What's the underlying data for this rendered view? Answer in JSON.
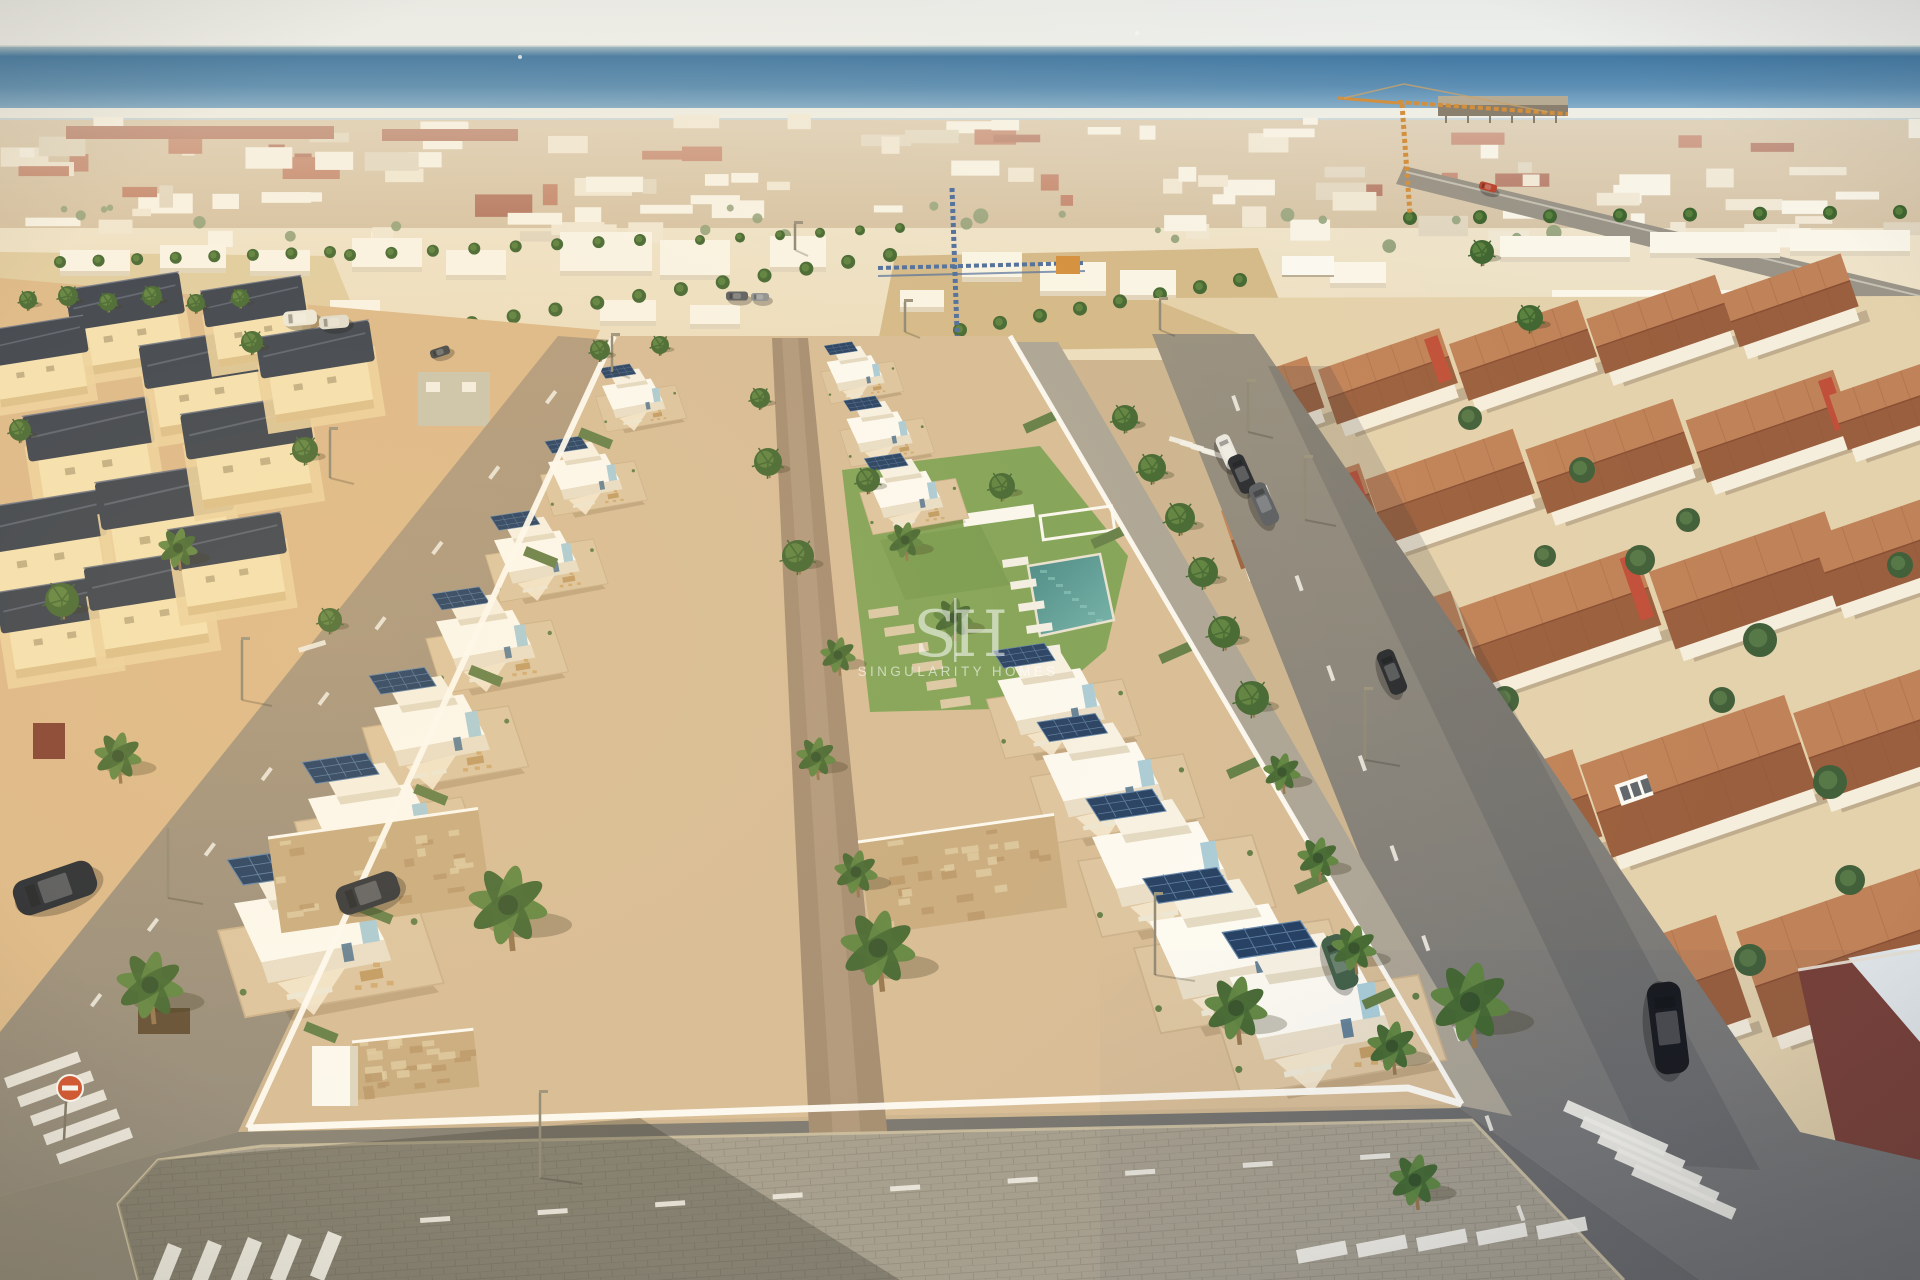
{
  "meta": {
    "description": "Aerial drone render of a new-build residential development of white modern villas with solar panels, communal lawn and pool, between older cream villas with dark roofs (left) and terracotta-roofed townhouses (right), sea and dense coastal town on the horizon, two construction cranes, palm-lined streets, zebra crossings on the corner roads.",
    "width": 1920,
    "height": 1280
  },
  "watermark": {
    "initial_left": "S",
    "separator": "|",
    "initial_right": "H",
    "brand": "SINGULARITY HOMES"
  },
  "palette": {
    "sky_top": "#e9ebe9",
    "sky_bottom": "#eef0ed",
    "sea_horizon": "#a3bcc7",
    "sea_deep": "#447aa4",
    "sea_mid": "#5d8fb4",
    "sea_light": "#a9c4d4",
    "surf": "#eef2ee",
    "distant_white": "#faf6ea",
    "distant_cream": "#efe5cf",
    "distant_shadow": "#d9cdb4",
    "roof_terracotta": "#ae5a3e",
    "roof_darkred": "#98462f",
    "sand": "#e0cda4",
    "sand_deep": "#d3b98a",
    "palm_dark": "#3f6531",
    "palm_light": "#5c8440",
    "trunk": "#93744e",
    "dev_ground": "#d6bc98",
    "dev_white": "#fdfcf7",
    "dev_shade": "#e8dfcc",
    "terrace": "#dcc5a2",
    "wood": "#bf9a63",
    "solar": "#1c3a62",
    "solar_grid": "#5d83ad",
    "accent_blue": "#a7ccdb",
    "accent_steel": "#4f7391",
    "lawn": "#7da257",
    "pool": "#3f8586",
    "pool_light": "#6fb3ae",
    "old_wall": "#f5e3b4",
    "old_roof": "#333d4d",
    "old_ground": "#dcb98b",
    "rq_wall": "#f6eedd",
    "rq_ground": "#e4d2ad",
    "red_gable": "#c1503a",
    "roof_hi": "#c08258",
    "roof_lo": "#9a5f3e",
    "asphalt_warm": "#a5927b",
    "asphalt": "#958e7e",
    "asphalt_cool": "#6f7174",
    "sidewalk": "#a39d8f",
    "sidewalk_line": "#938d7f",
    "curb": "#cabfa2",
    "white_wall": "#fefdf9",
    "stone": "#c7ab81",
    "crane_orange": "#d28f3e",
    "crane_blue": "#4a6c9e",
    "marking": "#f2f1ea",
    "brick_red": "#7a4038",
    "sign_red": "#d2512e"
  },
  "scene": {
    "polys": {
      "left_quarter": "0,278 600,330 236,1128 0,1040",
      "right_quarter": "1150,298 1920,296 1920,1280 1790,1280 1250,338",
      "plaza": "895,256 1258,248 1298,346 876,352",
      "left_lot": "0,252 332,256 362,330 0,342",
      "coast_road": "1404,166 1920,290 1920,314 1396,184",
      "left_street": "0,1032 558,336 612,340 238,1132 0,1196",
      "right_street": "1152,334 1254,334 1800,1132 1920,1160 1920,1280 1700,1280 1460,1108",
      "bottom_road": "0,1196 238,1132 1460,1108 1700,1280 0,1280",
      "right_walk": "1012,342 1058,342 1512,1116 1462,1106",
      "dev_plot": "614,336 1010,336 1462,1104 248,1128",
      "walkway": "772,338 808,338 902,1280 816,1280",
      "lawn": "842,470 1040,446 1128,556 1106,650 1038,708 870,712",
      "pool": "1028,566 1100,554 1114,620 1040,636",
      "sidewalk": "138,1280 118,1204 158,1160 262,1146 1472,1120 1624,1280",
      "walk_shadow": "118,1204 158,1160 640,1118 900,1280 138,1280",
      "brick_wall": "1798,970 1920,950 1920,1162 1838,1152",
      "brick_deck": "1848,958 1920,944 1920,1042",
      "street_shadow": "1268,366 1330,366 1760,1170 1650,1164"
    },
    "red_bands": [
      [
        66,
        126,
        268,
        13
      ],
      [
        382,
        129,
        136,
        12
      ]
    ],
    "mid_buildings": [
      [
        352,
        238,
        70,
        34,
        0
      ],
      [
        446,
        250,
        60,
        30,
        0
      ],
      [
        560,
        232,
        92,
        44,
        0
      ],
      [
        660,
        240,
        70,
        40,
        0
      ],
      [
        770,
        236,
        56,
        36,
        0
      ],
      [
        962,
        252,
        60,
        30,
        0
      ],
      [
        1040,
        262,
        66,
        34,
        0
      ],
      [
        1120,
        270,
        56,
        30,
        0
      ],
      [
        330,
        300,
        50,
        24,
        0
      ],
      [
        600,
        300,
        56,
        26,
        0
      ],
      [
        690,
        305,
        50,
        24,
        0
      ],
      [
        900,
        290,
        44,
        22,
        0
      ],
      [
        1330,
        262,
        56,
        26,
        0
      ],
      [
        60,
        250,
        70,
        26,
        0
      ],
      [
        160,
        245,
        66,
        28,
        0
      ],
      [
        250,
        250,
        60,
        26,
        0
      ],
      [
        0,
        300,
        44,
        22,
        0
      ],
      [
        1500,
        236,
        130,
        26,
        0
      ],
      [
        1650,
        232,
        130,
        26,
        0
      ],
      [
        1790,
        230,
        120,
        26,
        0
      ],
      [
        1552,
        290,
        280,
        52,
        1
      ]
    ],
    "pier": [
      1438,
      96,
      130,
      20
    ],
    "ships": [
      [
        1137,
        33
      ],
      [
        520,
        57
      ]
    ],
    "cranes": {
      "blue": {
        "tower": [
          952,
          188,
          958,
          360
        ],
        "jib": [
          878,
          268,
          1085,
          263
        ],
        "cab": [
          1056,
          256,
          24,
          18
        ]
      },
      "orange": {
        "tower": [
          1402,
          104,
          1410,
          214
        ],
        "jib": [
          1398,
          102,
          1568,
          114
        ],
        "counter": [
          1338,
          98,
          1398,
          103
        ],
        "apex": [
          1404,
          84
        ]
      }
    },
    "old_villas": [
      [
        128,
        320,
        0.9
      ],
      [
        38,
        358,
        0.8
      ],
      [
        92,
        450,
        1.0
      ],
      [
        44,
        543,
        1.0
      ],
      [
        205,
        378,
        0.95
      ],
      [
        256,
        318,
        0.8
      ],
      [
        168,
        518,
        1.05
      ],
      [
        250,
        448,
        1.0
      ],
      [
        318,
        368,
        0.9
      ],
      [
        58,
        623,
        0.9
      ],
      [
        150,
        600,
        0.95
      ],
      [
        230,
        560,
        0.9
      ]
    ],
    "left_extras": {
      "green_house": [
        418,
        372,
        72,
        54
      ],
      "container": [
        33,
        723,
        32,
        36
      ],
      "cabinet": [
        312,
        1046,
        46,
        60
      ],
      "corner_planter": [
        138,
        1008,
        52,
        26
      ]
    },
    "right_roofs": [
      [
        1258,
        408,
        118,
        54,
        -19,
        0
      ],
      [
        1390,
        382,
        120,
        58,
        -19,
        1
      ],
      [
        1525,
        356,
        128,
        60,
        -19,
        0
      ],
      [
        1662,
        330,
        128,
        58,
        -19,
        0
      ],
      [
        1792,
        306,
        118,
        56,
        -19,
        0
      ],
      [
        1302,
        522,
        138,
        62,
        -19,
        1
      ],
      [
        1452,
        492,
        148,
        68,
        -19,
        0
      ],
      [
        1612,
        462,
        148,
        68,
        -19,
        0
      ],
      [
        1772,
        432,
        148,
        66,
        -19,
        1
      ],
      [
        1900,
        408,
        118,
        58,
        -19,
        0
      ],
      [
        1382,
        662,
        168,
        78,
        -19,
        0
      ],
      [
        1562,
        622,
        178,
        82,
        -19,
        1
      ],
      [
        1752,
        586,
        178,
        82,
        -19,
        0
      ],
      [
        1900,
        552,
        148,
        74,
        -19,
        0
      ],
      [
        1492,
        832,
        198,
        92,
        -19,
        0
      ],
      [
        1700,
        782,
        208,
        98,
        -19,
        0
      ],
      [
        1898,
        732,
        178,
        92,
        -19,
        1
      ],
      [
        1624,
        1010,
        228,
        108,
        -19,
        0
      ],
      [
        1868,
        952,
        228,
        112,
        -19,
        0
      ]
    ],
    "conservatories": [
      [
        1312,
        592
      ],
      [
        1634,
        790
      ],
      [
        1520,
        960
      ]
    ],
    "rq_pool": [
      1200,
      862,
      34,
      18,
      -19
    ],
    "rq_trees": [
      [
        1640,
        560,
        15
      ],
      [
        1582,
        470,
        13
      ],
      [
        1760,
        640,
        17
      ],
      [
        1505,
        700,
        14
      ],
      [
        1830,
        782,
        17
      ],
      [
        1900,
        565,
        13
      ],
      [
        1470,
        418,
        12
      ],
      [
        1688,
        520,
        12
      ],
      [
        1545,
        556,
        11
      ],
      [
        1722,
        700,
        13
      ],
      [
        1850,
        880,
        15
      ],
      [
        1600,
        900,
        14
      ],
      [
        1750,
        960,
        16
      ]
    ],
    "dev_villas_left": [
      [
        648,
        408,
        0.46
      ],
      [
        602,
        488,
        0.54
      ],
      [
        556,
        570,
        0.62
      ],
      [
        508,
        656,
        0.72
      ],
      [
        458,
        748,
        0.84
      ],
      [
        404,
        845,
        0.96
      ],
      [
        348,
        958,
        1.14
      ]
    ],
    "dev_villas_right": [
      [
        856,
        382,
        0.42
      ],
      [
        880,
        442,
        0.48
      ],
      [
        906,
        506,
        0.55
      ],
      [
        1052,
        718,
        0.78
      ],
      [
        1104,
        798,
        0.88
      ],
      [
        1162,
        885,
        1.0
      ],
      [
        1228,
        975,
        1.12
      ],
      [
        1312,
        1034,
        1.18
      ]
    ],
    "stone_walls": [
      [
        268,
        838,
        212,
        96,
        -8
      ],
      [
        858,
        842,
        198,
        94,
        -8
      ],
      [
        352,
        1042,
        122,
        58,
        -6
      ]
    ],
    "garden": {
      "bench": [
        962,
        514,
        72,
        13,
        -8
      ],
      "pergola": [
        1040,
        516,
        72,
        24,
        -8
      ],
      "loungers_white": [
        [
          1002,
          560
        ],
        [
          1010,
          582
        ],
        [
          1018,
          604
        ],
        [
          1026,
          626
        ],
        [
          1034,
          648
        ]
      ],
      "loungers_tan": [
        [
          868,
          610
        ],
        [
          884,
          628
        ],
        [
          898,
          646
        ],
        [
          912,
          664
        ],
        [
          926,
          682
        ],
        [
          940,
          700
        ]
      ]
    },
    "palms": [
      [
        178,
        548,
        20
      ],
      [
        118,
        756,
        24
      ],
      [
        62,
        600,
        17
      ],
      [
        305,
        450,
        13
      ],
      [
        252,
        342,
        11
      ],
      [
        508,
        905,
        40
      ],
      [
        878,
        948,
        38
      ],
      [
        1236,
        1008,
        32
      ],
      [
        1470,
        1002,
        40
      ],
      [
        1415,
        1180,
        26
      ],
      [
        150,
        985,
        34
      ],
      [
        768,
        462,
        14
      ],
      [
        798,
        556,
        16
      ],
      [
        838,
        655,
        18
      ],
      [
        816,
        757,
        20
      ],
      [
        856,
        872,
        22
      ],
      [
        760,
        398,
        10
      ],
      [
        905,
        540,
        18
      ],
      [
        953,
        618,
        20
      ],
      [
        1002,
        486,
        13
      ],
      [
        868,
        480,
        12
      ],
      [
        1125,
        418,
        13
      ],
      [
        1152,
        468,
        14
      ],
      [
        1180,
        518,
        15
      ],
      [
        1203,
        572,
        15
      ],
      [
        1224,
        632,
        16
      ],
      [
        1252,
        698,
        17
      ],
      [
        1282,
        772,
        19
      ],
      [
        1318,
        858,
        21
      ],
      [
        1354,
        948,
        23
      ],
      [
        1392,
        1046,
        25
      ],
      [
        1530,
        318,
        13
      ],
      [
        1482,
        252,
        12
      ],
      [
        28,
        300,
        9
      ],
      [
        68,
        296,
        10
      ],
      [
        108,
        302,
        9
      ],
      [
        152,
        296,
        10
      ],
      [
        196,
        303,
        9
      ],
      [
        240,
        298,
        9
      ],
      [
        20,
        430,
        11
      ],
      [
        330,
        620,
        12
      ],
      [
        600,
        350,
        10
      ],
      [
        660,
        345,
        9
      ]
    ],
    "palm_rows": [
      [
        430,
        330,
        890,
        255,
        12,
        7
      ],
      [
        960,
        330,
        1240,
        280,
        8,
        7
      ],
      [
        350,
        255,
        640,
        240,
        8,
        6
      ],
      [
        60,
        262,
        330,
        252,
        8,
        6
      ],
      [
        1410,
        218,
        1900,
        212,
        8,
        7
      ],
      [
        700,
        240,
        900,
        228,
        6,
        5
      ]
    ],
    "cars": [
      [
        55,
        888,
        84,
        36,
        -19,
        "#1d2430"
      ],
      [
        368,
        893,
        64,
        30,
        -19,
        "#2b3038"
      ],
      [
        300,
        318,
        34,
        15,
        -5,
        "#eceadf"
      ],
      [
        334,
        322,
        30,
        13,
        -5,
        "#dfddd2"
      ],
      [
        1228,
        452,
        36,
        15,
        66,
        "#e9e8e2"
      ],
      [
        1242,
        474,
        40,
        17,
        66,
        "#23272f"
      ],
      [
        1264,
        504,
        44,
        18,
        66,
        "#575c63"
      ],
      [
        1392,
        672,
        46,
        18,
        68,
        "#26292f"
      ],
      [
        1668,
        1028,
        92,
        34,
        83,
        "#17191e"
      ],
      [
        1340,
        962,
        56,
        24,
        70,
        "#3c5c47"
      ],
      [
        1488,
        187,
        18,
        8,
        15,
        "#b8452e"
      ],
      [
        737,
        296,
        22,
        9,
        0,
        "#565b62"
      ],
      [
        760,
        297,
        18,
        8,
        0,
        "#8a8f94"
      ],
      [
        440,
        352,
        20,
        9,
        -18,
        "#3d4248"
      ]
    ],
    "lamps": [
      [
        242,
        700,
        60
      ],
      [
        330,
        478,
        48
      ],
      [
        168,
        898,
        70
      ],
      [
        540,
        1178,
        85
      ],
      [
        1305,
        520,
        62
      ],
      [
        1248,
        432,
        50
      ],
      [
        1365,
        760,
        70
      ],
      [
        1155,
        975,
        80
      ],
      [
        612,
        372,
        36
      ],
      [
        905,
        332,
        30
      ],
      [
        795,
        250,
        26
      ],
      [
        1160,
        330,
        30
      ]
    ],
    "sign": [
      70,
      1088,
      13
    ],
    "crosswalks": [
      {
        "x": 4,
        "y": 1078,
        "n": 5,
        "dx": 13,
        "dy": 19,
        "w": 78,
        "h": 11,
        "rot": -20
      },
      {
        "x": 168,
        "y": 1243,
        "n": 5,
        "dx": 40,
        "dy": -3,
        "w": 15,
        "h": 48,
        "rot": 22
      },
      {
        "x": 1296,
        "y": 1250,
        "n": 5,
        "dx": 60,
        "dy": -6,
        "w": 50,
        "h": 14,
        "rot": -11
      },
      {
        "x": 1568,
        "y": 1100,
        "n": 5,
        "dx": 17,
        "dy": 16,
        "w": 110,
        "h": 12,
        "rot": 24
      },
      {
        "x": 1170,
        "y": 436,
        "n": 4,
        "dx": 11,
        "dy": 4,
        "w": 24,
        "h": 5,
        "rot": 16
      }
    ],
    "dash_lines": [
      [
        90,
        1005,
        545,
        402,
        9,
        15,
        4
      ],
      [
        1235,
        395,
        1520,
        1205,
        10,
        16,
        4
      ],
      [
        420,
        1218,
        1360,
        1155,
        9,
        30,
        5
      ]
    ],
    "stop_bar": [
      298,
      648,
      28,
      5,
      -17
    ]
  }
}
